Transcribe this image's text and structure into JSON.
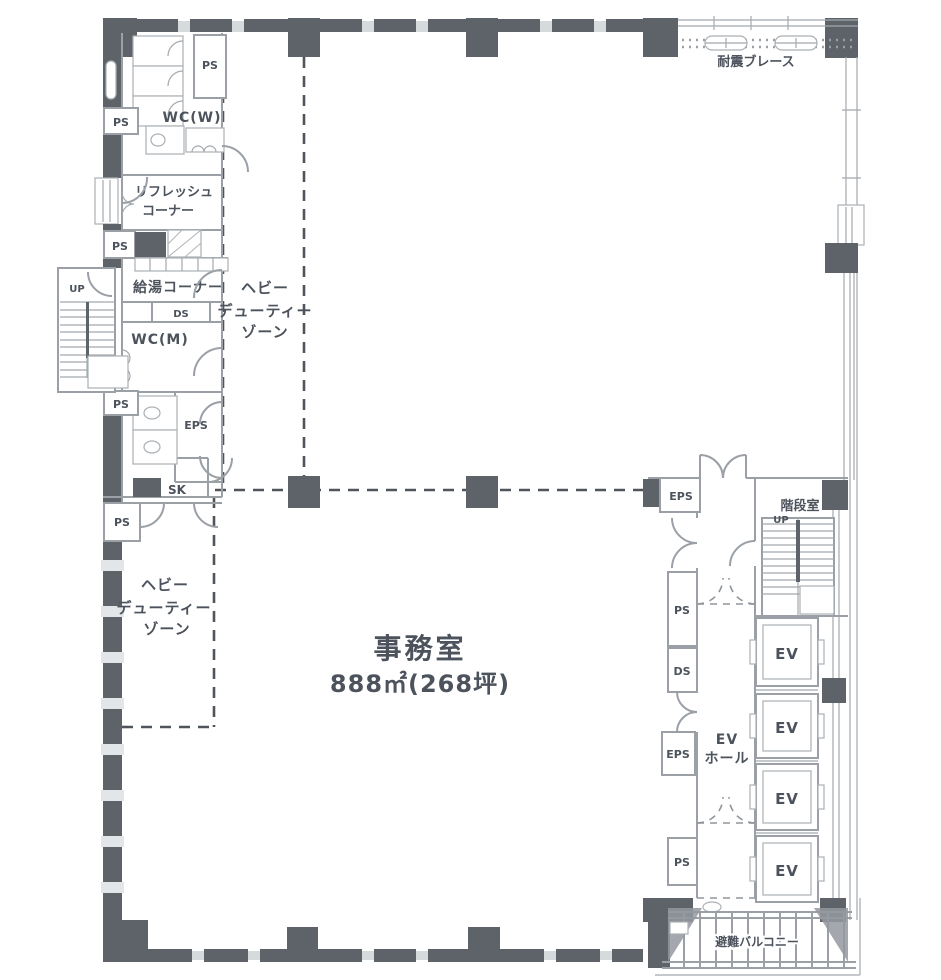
{
  "floorplan": {
    "office": {
      "name": "事務室",
      "area": "888㎡(268坪)"
    },
    "rooms": {
      "wc_w": "WC(W)",
      "wc_m": "WC(M)",
      "refresh1": "リフレッシュ",
      "refresh2": "コーナー",
      "kyuto": "給湯コーナー",
      "stair": "階段室",
      "sk": "SK",
      "ev": "EV",
      "ev_hall1": "EV",
      "ev_hall2": "ホール",
      "balcony": "避難バルコニー"
    },
    "shafts": {
      "ps": "PS",
      "ds": "DS",
      "eps": "EPS"
    },
    "marks": {
      "up": "UP",
      "brace": "耐震ブレース",
      "zone1": "ヘビー",
      "zone2": "デューティー",
      "zone3": "ゾーン"
    },
    "colors": {
      "wall_line": "#9aa0a6",
      "wall_dark": "#5d6368",
      "window_band": "#d6dadd",
      "text": "#4c535c",
      "zone_dash": "#4f555b"
    }
  }
}
